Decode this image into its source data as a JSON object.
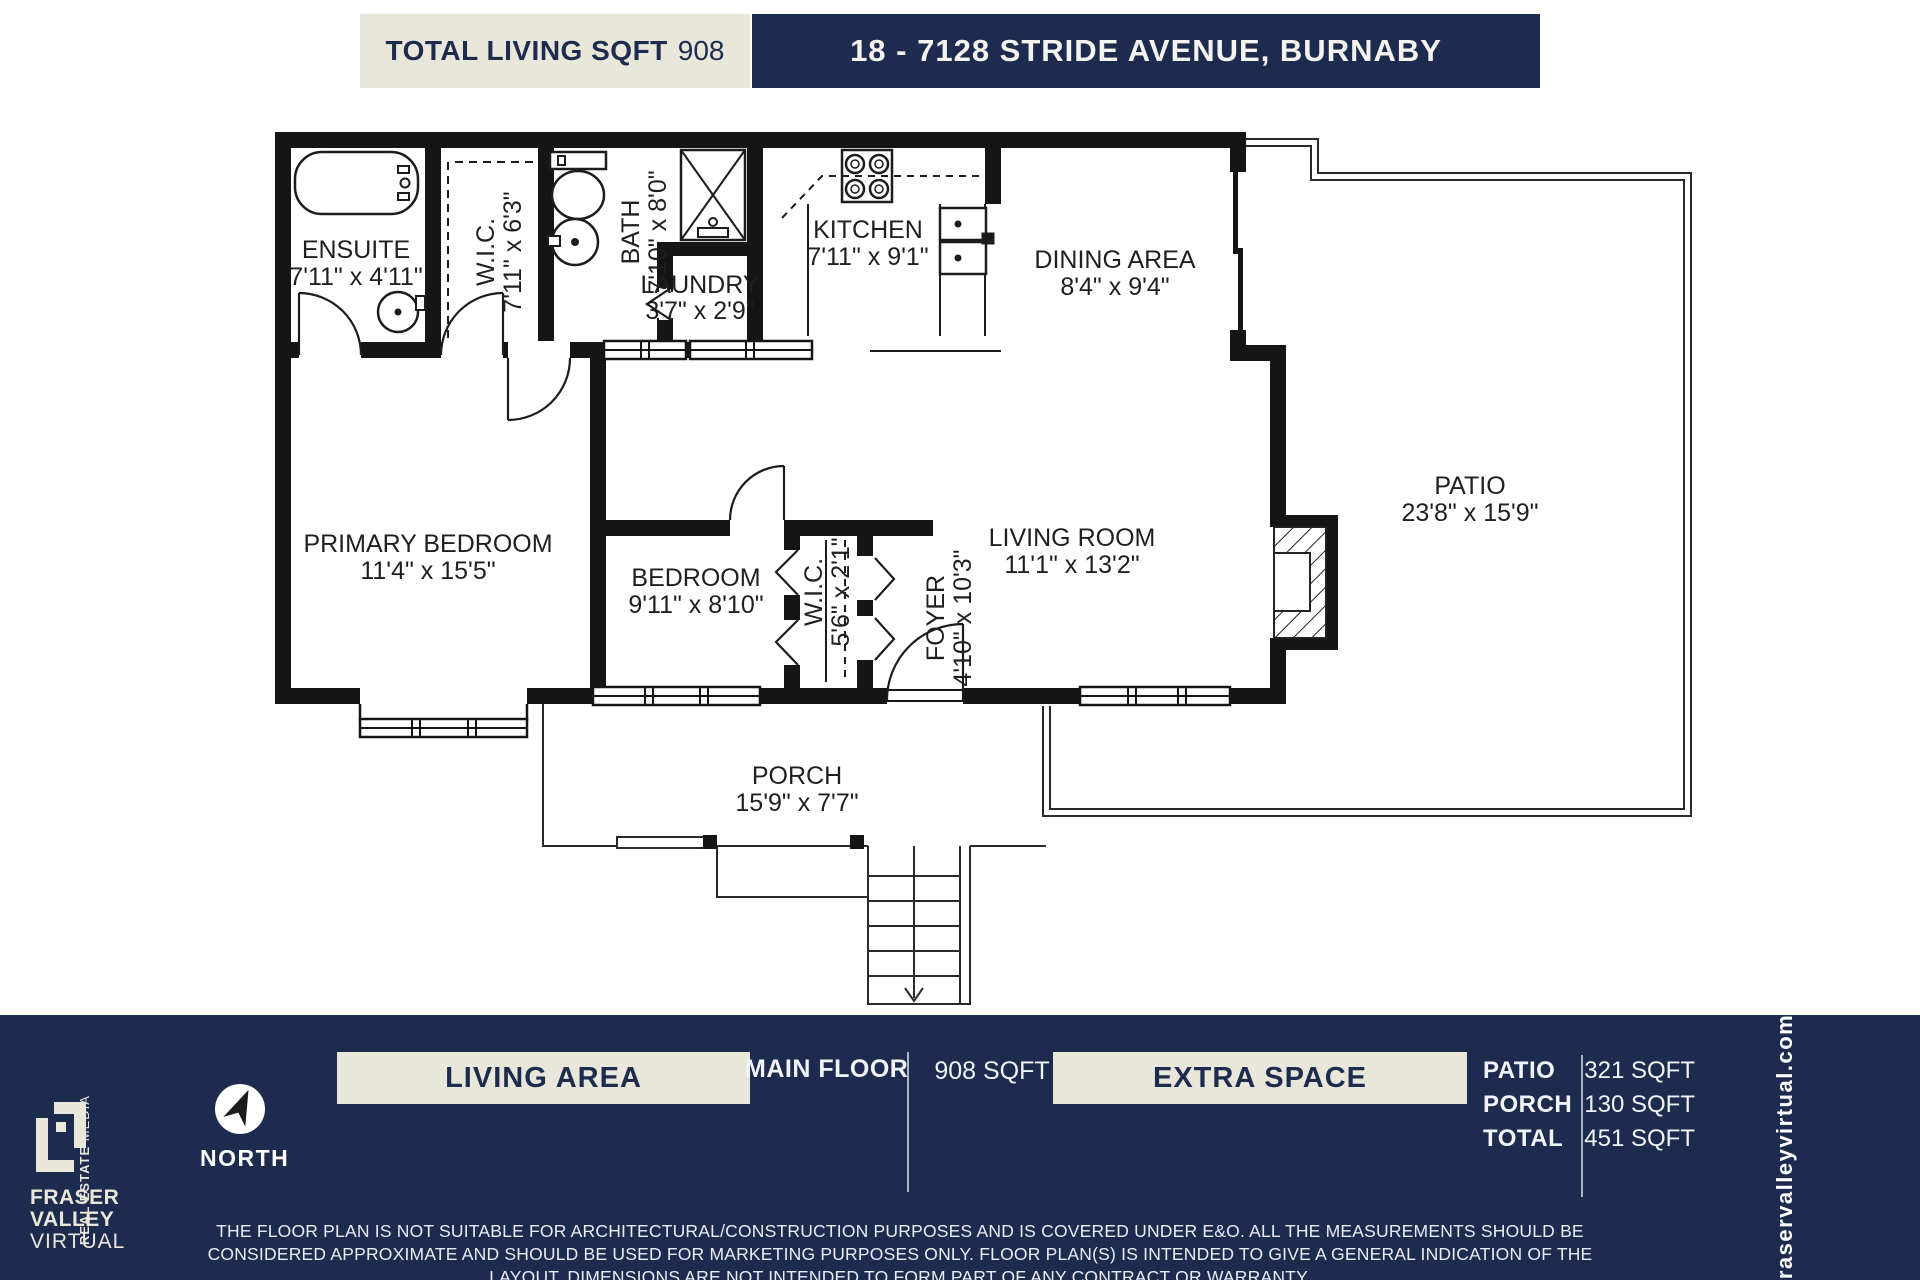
{
  "header": {
    "total_label": "TOTAL LIVING SQFT",
    "total_value": "908",
    "address": "18 - 7128 STRIDE AVENUE, BURNABY"
  },
  "rooms": {
    "ensuite": {
      "name": "ENSUITE",
      "dims": "7'11\" x 4'11\""
    },
    "wic_primary": {
      "name": "W.I.C.",
      "dims": "7'11\" x 6'3\""
    },
    "bath": {
      "name": "BATH",
      "dims": "7'10\" x 8'0\""
    },
    "laundry": {
      "name": "LAUNDRY",
      "dims": "3'7\" x 2'9\""
    },
    "kitchen": {
      "name": "KITCHEN",
      "dims": "7'11\" x 9'1\""
    },
    "dining": {
      "name": "DINING AREA",
      "dims": "8'4\" x 9'4\""
    },
    "primary_bedroom": {
      "name": "PRIMARY BEDROOM",
      "dims": "11'4\" x 15'5\""
    },
    "bedroom": {
      "name": "BEDROOM",
      "dims": "9'11\" x 8'10\""
    },
    "wic_bedroom": {
      "name": "W.I.C.",
      "dims": "5'6\" x 2'1\""
    },
    "foyer": {
      "name": "FOYER",
      "dims": "4'10\" x 10'3\""
    },
    "living": {
      "name": "LIVING ROOM",
      "dims": "11'1\" x 13'2\""
    },
    "patio": {
      "name": "PATIO",
      "dims": "23'8\" x 15'9\""
    },
    "porch": {
      "name": "PORCH",
      "dims": "15'9\" x 7'7\""
    }
  },
  "footer": {
    "living_area_label": "LIVING AREA",
    "floor_label": "MAIN FLOOR",
    "floor_value": "908 SQFT",
    "extra_space_label": "EXTRA SPACE",
    "extra": [
      {
        "label": "PATIO",
        "value": "321 SQFT"
      },
      {
        "label": "PORCH",
        "value": "130 SQFT"
      },
      {
        "label": "TOTAL",
        "value": "451 SQFT"
      }
    ],
    "north_label": "NORTH",
    "disclaimer": "THE FLOOR PLAN IS NOT SUITABLE FOR ARCHITECTURAL/CONSTRUCTION PURPOSES AND IS COVERED UNDER E&O. ALL THE MEASUREMENTS SHOULD BE CONSIDERED APPROXIMATE AND SHOULD BE USED FOR MARKETING PURPOSES ONLY. FLOOR PLAN(S) IS INTENDED TO GIVE A GENERAL INDICATION OF THE LAYOUT. DIMENSIONS ARE NOT INTENDED TO FORM PART OF ANY CONTRACT OR WARRANTY.",
    "website": "fraservalleyvirtual.com",
    "brand": {
      "line1": "FRASER",
      "line2": "VALLEY",
      "line3": "VIRTUAL",
      "tagline_bold": "REAL ESTATE",
      "tagline_light": "MEDIA"
    }
  },
  "colors": {
    "navy": "#1d2c4e",
    "beige": "#e9e6da",
    "ink": "#1a1a1a"
  }
}
